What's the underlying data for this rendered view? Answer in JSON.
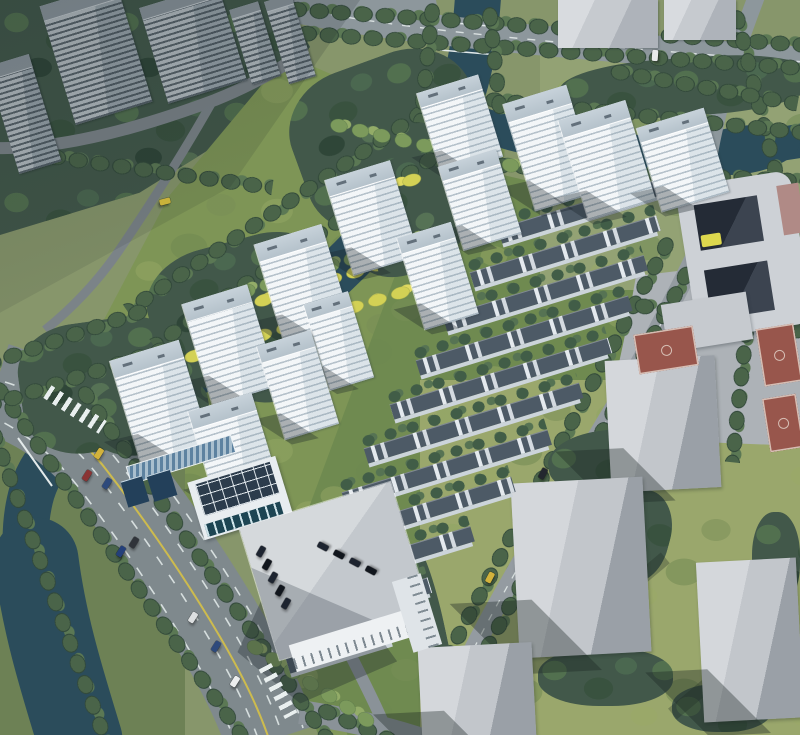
{
  "canvas": {
    "width": 800,
    "height": 735
  },
  "palette": {
    "grass_base": "#87966b",
    "grass_site": "#7e9556",
    "grass_rows": "#6f8a50",
    "grass_context": "#9aa76c",
    "water": "#2b4c5b",
    "woods": "#42584a",
    "tree_dark": "#3a523f",
    "tree_bright": "#7c9a5c",
    "hedge_yellow": "#d3d155",
    "road": "#8d979c",
    "road_major": "#7f898d",
    "lane_marking": "#d9e0e0",
    "lane_yellow": "#cdbb4e",
    "tower_face": "#f3f6f8",
    "tower_shade": "#dce4e9",
    "tower_roof": "#c7d2da",
    "old_tower": "#b4bcc1",
    "townhouse_roof": "#4d5a66",
    "townhouse_wall": "#ccd4da",
    "massing_light": "#d4d7db",
    "massing_dark": "#9aa0a7",
    "school_face": "#cdd1d6",
    "courtyard_dark": "#242b36",
    "accent_yellow": "#ddd84e",
    "court_red": "#98564c",
    "solar_blue": "#5d82a0",
    "pool": "#1d4553",
    "shadow": "rgba(24,34,40,0.33)"
  },
  "scene": {
    "type": "aerial-architectural-rendering",
    "new_towers": 13,
    "existing_towers": 5,
    "townhouse_rows": 11,
    "context_blocks": 6,
    "basketball_courts": 3,
    "vehicles": [
      {
        "x": 96,
        "y": 448,
        "r": 32,
        "c": "#d2b23c"
      },
      {
        "x": 84,
        "y": 470,
        "r": 32,
        "c": "#8a3434"
      },
      {
        "x": 104,
        "y": 478,
        "r": 32,
        "c": "#2e4a7c"
      },
      {
        "x": 118,
        "y": 546,
        "r": 32,
        "c": "#24407a"
      },
      {
        "x": 131,
        "y": 537,
        "r": 32,
        "c": "#30343a"
      },
      {
        "x": 190,
        "y": 612,
        "r": 32,
        "c": "#dcdfe0"
      },
      {
        "x": 213,
        "y": 641,
        "r": 32,
        "c": "#2e4a7c"
      },
      {
        "x": 232,
        "y": 676,
        "r": 32,
        "c": "#eceeee"
      },
      {
        "x": 162,
        "y": 196,
        "r": 75,
        "c": "#c9b23a"
      },
      {
        "x": 487,
        "y": 572,
        "r": 28,
        "c": "#d2b23c"
      },
      {
        "x": 540,
        "y": 468,
        "r": 28,
        "c": "#23272e"
      },
      {
        "x": 652,
        "y": 50,
        "r": 4,
        "c": "#e8eaea"
      },
      {
        "x": 258,
        "y": 546,
        "r": 30,
        "c": "#1d2430"
      },
      {
        "x": 264,
        "y": 559,
        "r": 30,
        "c": "#11161d"
      },
      {
        "x": 270,
        "y": 572,
        "r": 30,
        "c": "#1d2430"
      },
      {
        "x": 277,
        "y": 585,
        "r": 30,
        "c": "#11161d"
      },
      {
        "x": 283,
        "y": 598,
        "r": 30,
        "c": "#1d2430"
      },
      {
        "x": 320,
        "y": 541,
        "r": -62,
        "c": "#1d2430"
      },
      {
        "x": 336,
        "y": 549,
        "r": -62,
        "c": "#11161d"
      },
      {
        "x": 352,
        "y": 557,
        "r": -62,
        "c": "#1d2430"
      },
      {
        "x": 368,
        "y": 565,
        "r": -62,
        "c": "#11161d"
      }
    ]
  }
}
